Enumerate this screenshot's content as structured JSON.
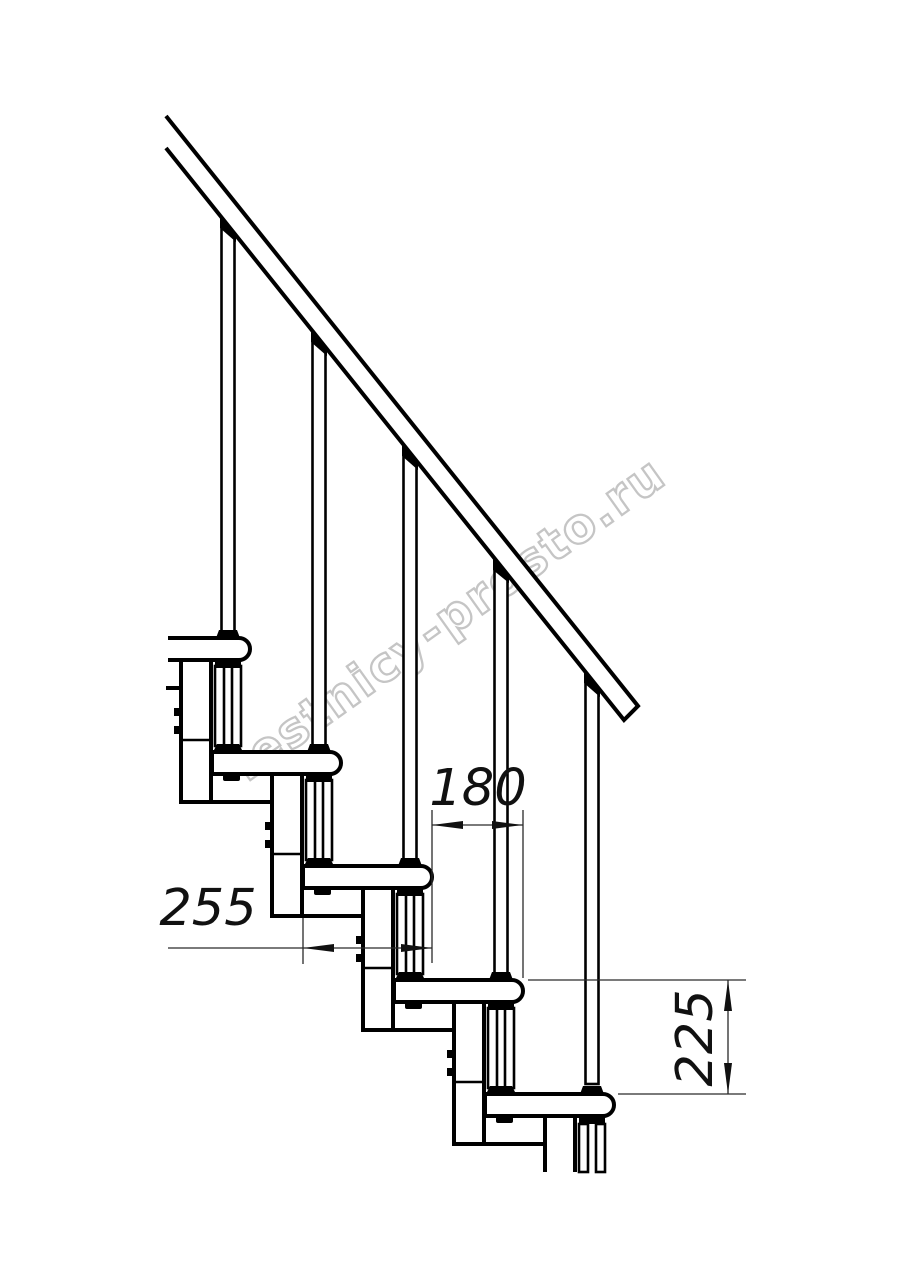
{
  "drawing": {
    "title": "modular-staircase-side-view",
    "watermark": {
      "text": "lestnicy-prosto.ru",
      "color": "#bfbfbf"
    },
    "dimensions": {
      "step_run": {
        "value": "180",
        "orientation": "horizontal"
      },
      "tread_depth": {
        "value": "255",
        "orientation": "horizontal"
      },
      "step_height": {
        "value": "225",
        "orientation": "vertical"
      }
    },
    "colors": {
      "line": "#000000",
      "background": "#ffffff",
      "dimension_line": "#2a2a2a",
      "watermark": "#bfbfbf"
    }
  }
}
